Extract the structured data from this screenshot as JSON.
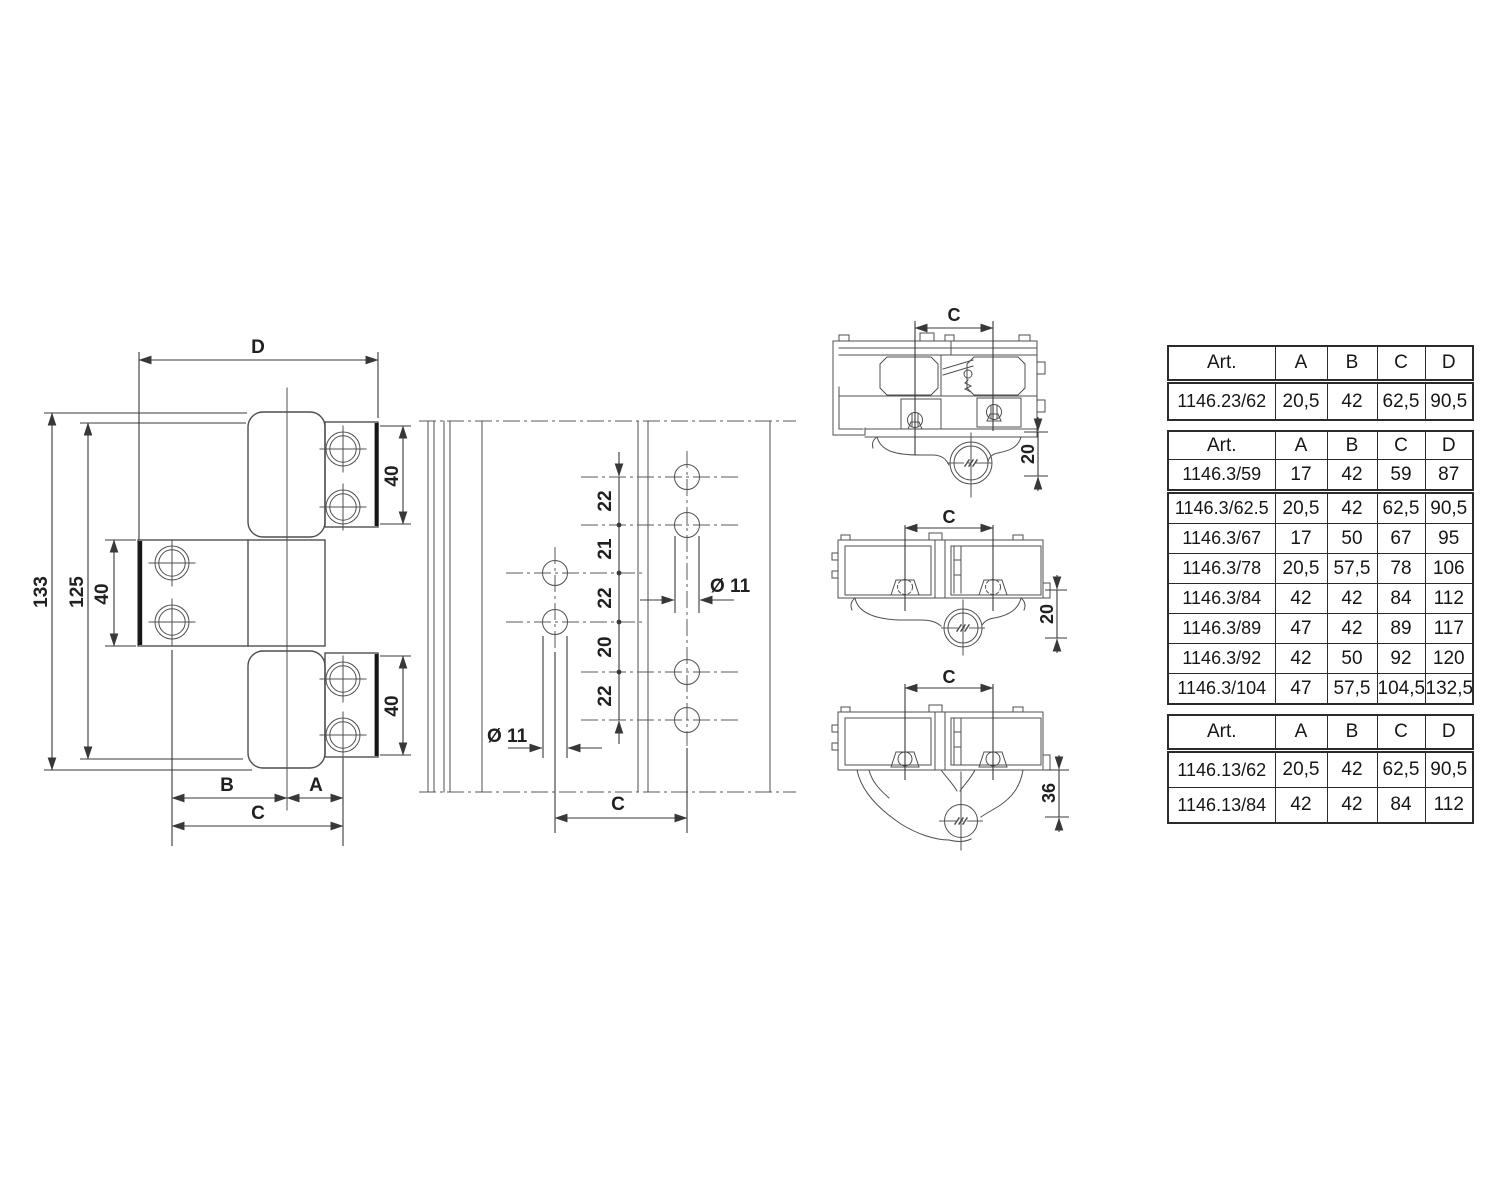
{
  "colors": {
    "line": "#4f4f4f",
    "dimension": "#383838",
    "thick_edge": "#161616",
    "table_border": "#2b2b2b",
    "text": "#161616",
    "background": "#ffffff"
  },
  "front_view": {
    "dim_overall_width": "D",
    "dim_total_height": "133",
    "dim_plate_height": "125",
    "dim_leaf_height_left": "40",
    "dim_leaf_height_top_right": "40",
    "dim_leaf_height_bottom_right": "40",
    "dim_b": "B",
    "dim_a": "A",
    "dim_c": "C"
  },
  "hole_pattern_view": {
    "chain": [
      "22",
      "21",
      "22",
      "20",
      "22"
    ],
    "hole_diameter_right": "Ø 11",
    "hole_diameter_left": "Ø 11",
    "dim_c": "C"
  },
  "cross_sections": [
    {
      "dim_c": "C",
      "dim_offset": "20"
    },
    {
      "dim_c": "C",
      "dim_offset": "20"
    },
    {
      "dim_c": "C",
      "dim_offset": "36"
    }
  ],
  "tables": [
    {
      "headers": [
        "Art.",
        "A",
        "B",
        "C",
        "D"
      ],
      "rows": [
        [
          "1146.23/62",
          "20,5",
          "42",
          "62,5",
          "90,5"
        ]
      ]
    },
    {
      "headers": [
        "Art.",
        "A",
        "B",
        "C",
        "D"
      ],
      "rows": [
        [
          "1146.3/59",
          "17",
          "42",
          "59",
          "87"
        ],
        [
          "1146.3/62.5",
          "20,5",
          "42",
          "62,5",
          "90,5"
        ],
        [
          "1146.3/67",
          "17",
          "50",
          "67",
          "95"
        ],
        [
          "1146.3/78",
          "20,5",
          "57,5",
          "78",
          "106"
        ],
        [
          "1146.3/84",
          "42",
          "42",
          "84",
          "112"
        ],
        [
          "1146.3/89",
          "47",
          "42",
          "89",
          "117"
        ],
        [
          "1146.3/92",
          "42",
          "50",
          "92",
          "120"
        ],
        [
          "1146.3/104",
          "47",
          "57,5",
          "104,5",
          "132,5"
        ]
      ]
    },
    {
      "headers": [
        "Art.",
        "A",
        "B",
        "C",
        "D"
      ],
      "rows": [
        [
          "1146.13/62",
          "20,5",
          "42",
          "62,5",
          "90,5"
        ],
        [
          "1146.13/84",
          "42",
          "42",
          "84",
          "112"
        ]
      ]
    }
  ]
}
